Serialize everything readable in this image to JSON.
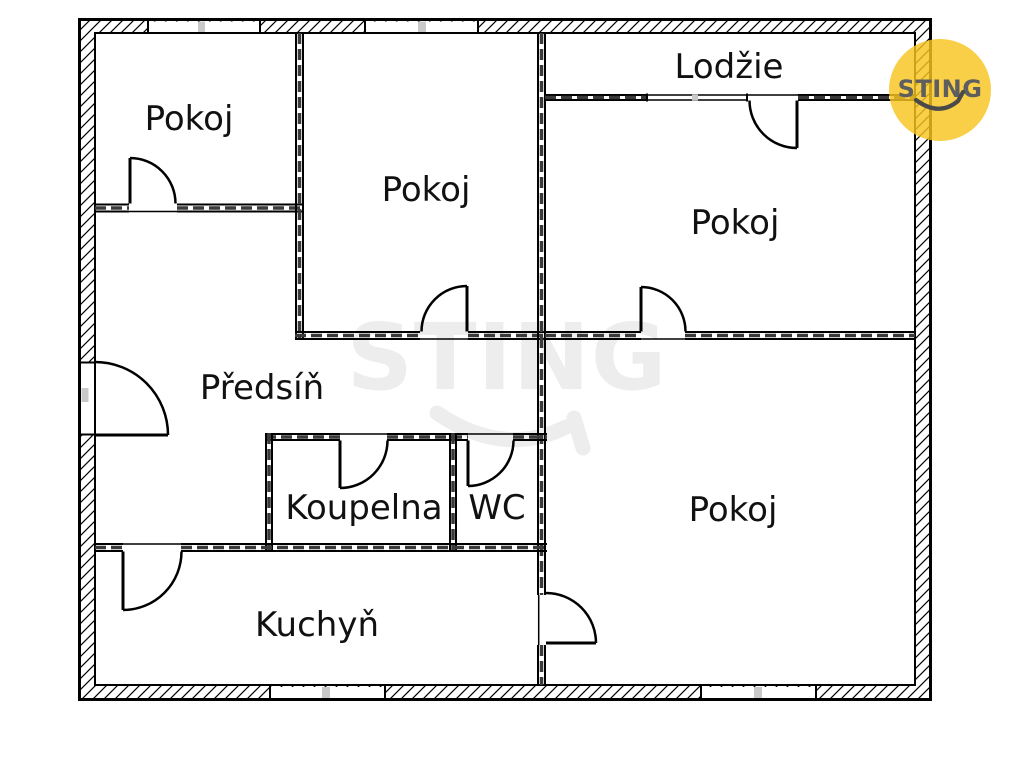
{
  "plan": {
    "title": "Apartment floor plan",
    "rooms": [
      {
        "key": "pokoj_top_left",
        "label": "Pokoj"
      },
      {
        "key": "pokoj_center",
        "label": "Pokoj"
      },
      {
        "key": "pokoj_top_right",
        "label": "Pokoj"
      },
      {
        "key": "pokoj_bottom_right",
        "label": "Pokoj"
      },
      {
        "key": "lodzie",
        "label": "Lodžie"
      },
      {
        "key": "predsin",
        "label": "Předsíň"
      },
      {
        "key": "koupelna",
        "label": "Koupelna"
      },
      {
        "key": "wc",
        "label": "WC"
      },
      {
        "key": "kuchyn",
        "label": "Kuchyň"
      }
    ]
  },
  "watermark": {
    "text": "STING"
  },
  "logo": {
    "text": "STING"
  },
  "colors": {
    "wall_line": "#000000",
    "window_tick": "#c9c9c9",
    "watermark": "#ededed",
    "logo_bg": "#f7c41e",
    "logo_text": "#5e5e5e"
  }
}
